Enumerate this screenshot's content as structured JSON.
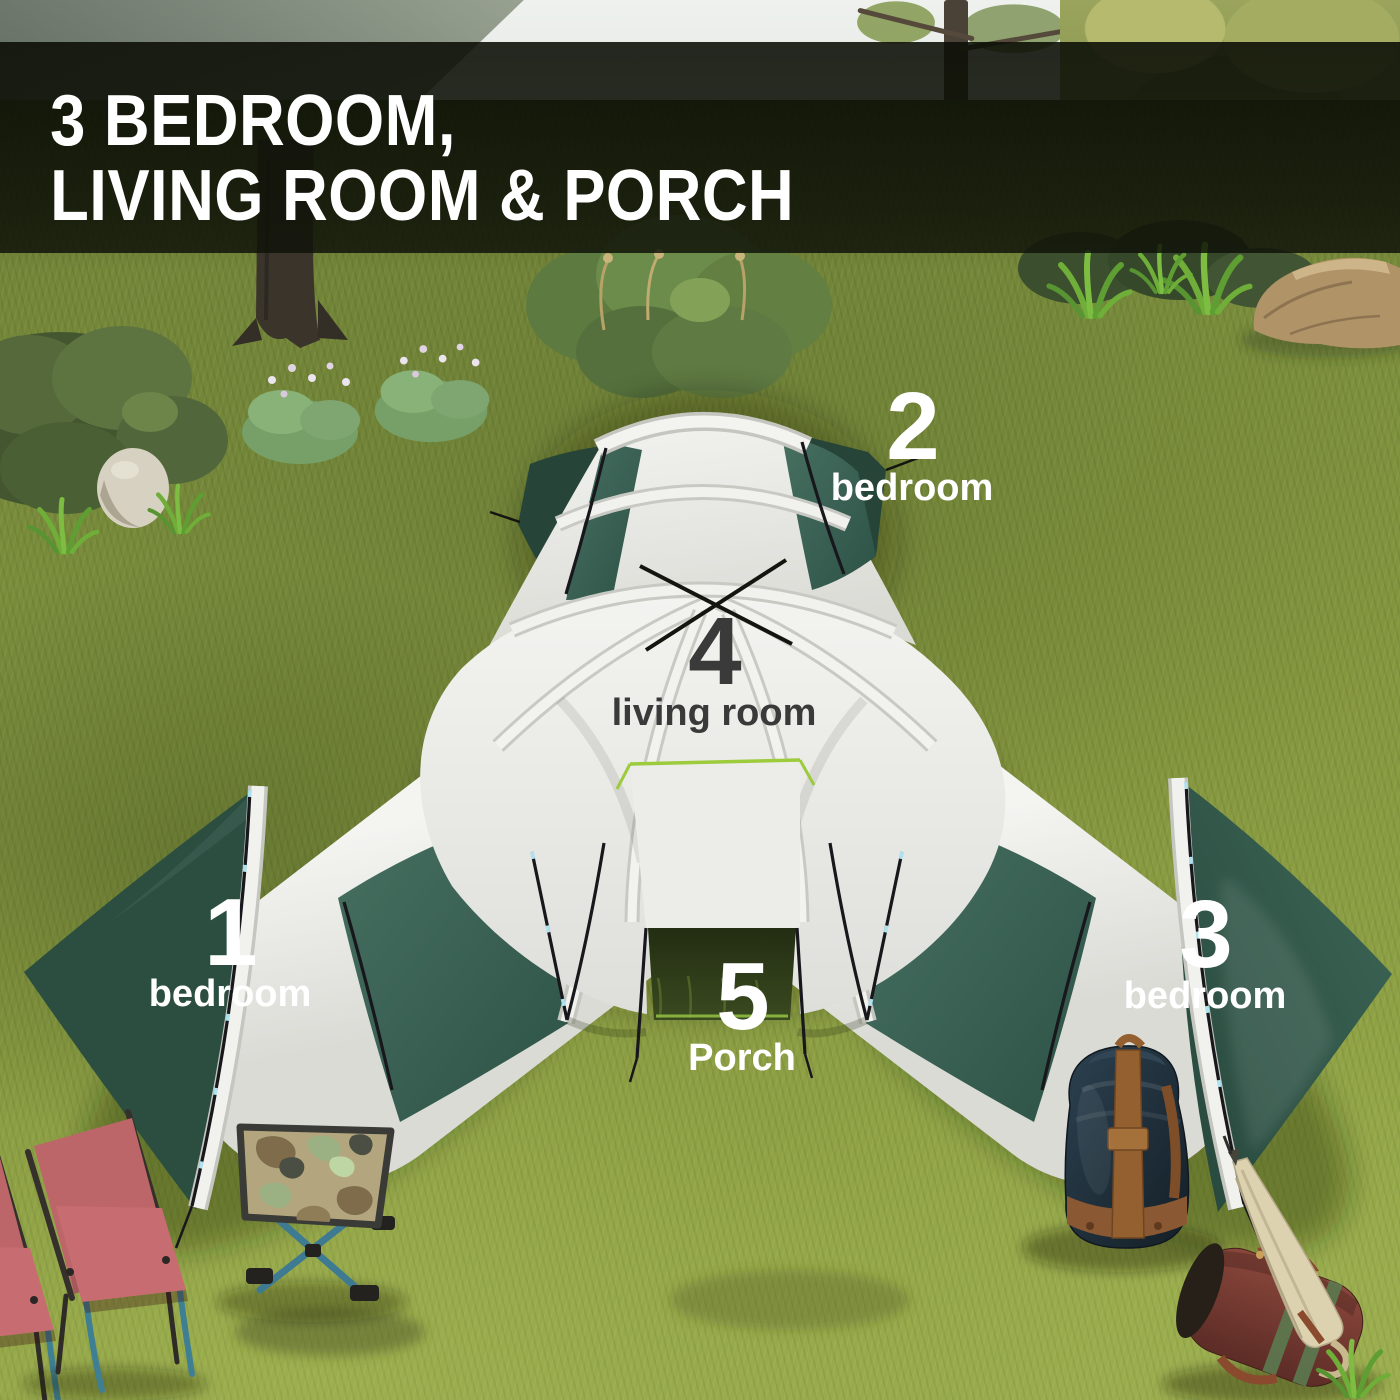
{
  "banner": {
    "title_line1": "3 BEDROOM,",
    "title_line2": "LIVING ROOM & PORCH",
    "text_color": "#ffffff",
    "background": "rgba(14,17,8,0.86)"
  },
  "labels": [
    {
      "number": "1",
      "name": "bedroom",
      "style": "light"
    },
    {
      "number": "2",
      "name": "bedroom",
      "style": "light"
    },
    {
      "number": "3",
      "name": "bedroom",
      "style": "light"
    },
    {
      "number": "4",
      "name": "living room",
      "style": "dark"
    },
    {
      "number": "5",
      "name": "Porch",
      "style": "light"
    }
  ],
  "palette": {
    "label_light": "#ffffff",
    "label_dark": "#3a3a3a",
    "tent_white": "#e9eae6",
    "tent_green_panel": "#3a6354",
    "tent_green_cap": "#2b4e41",
    "porch_trim_lime": "#9ccb3c",
    "grass_base": "#85973f",
    "chair_pink": "#c16a6e",
    "frame_teal": "#3e7d93",
    "backpack_navy": "#22333f",
    "duffel_brown": "#7e4034",
    "umbrella_cream": "#ddd2b0"
  },
  "scene": {
    "objects": [
      "tent",
      "camping-chair",
      "camping-chair",
      "camo-stool",
      "backpack",
      "duffel-bag",
      "umbrella",
      "bushes",
      "flowers",
      "rocks",
      "mountain",
      "trees"
    ]
  }
}
